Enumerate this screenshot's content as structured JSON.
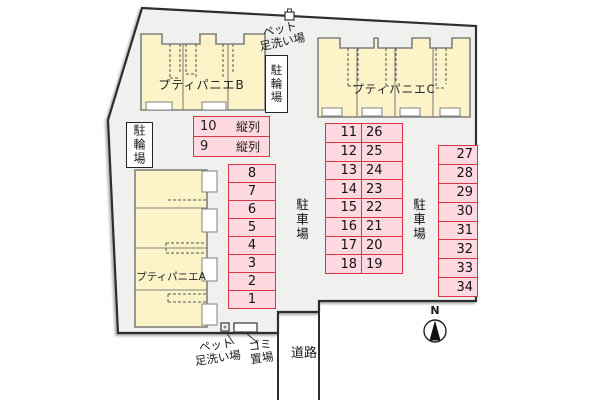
{
  "plan": {
    "buildings": [
      {
        "id": "A",
        "label": "プティパニエA"
      },
      {
        "id": "B",
        "label": "プティパニエB"
      },
      {
        "id": "C",
        "label": "プティパニエC"
      }
    ],
    "labels": {
      "bicycle_parking": "駐輪場",
      "parking_lot": "駐車場",
      "pet_wash_line1": "ペット",
      "pet_wash_line2": "足洗い場",
      "garbage_line1": "ゴミ",
      "garbage_line2": "置場",
      "road": "道路",
      "north": "N"
    },
    "parking": {
      "tandem_spots": [
        {
          "number": "10",
          "type": "縦列"
        },
        {
          "number": "9",
          "type": "縦列"
        }
      ],
      "left_column": [
        "8",
        "7",
        "6",
        "5",
        "4",
        "3",
        "2",
        "1"
      ],
      "middle_left_column": [
        "11",
        "12",
        "13",
        "14",
        "15",
        "16",
        "17",
        "18"
      ],
      "middle_right_column": [
        "26",
        "25",
        "24",
        "23",
        "22",
        "21",
        "20",
        "19"
      ],
      "right_column": [
        "27",
        "28",
        "29",
        "30",
        "31",
        "32",
        "33",
        "34"
      ]
    },
    "colors": {
      "site_fill": "#f0f0ee",
      "building_fill": "#fcf4c8",
      "building_border": "#808080",
      "parking_fill": "#ffd9e1",
      "parking_border": "#d93644",
      "outline": "#2e2e2e"
    }
  }
}
